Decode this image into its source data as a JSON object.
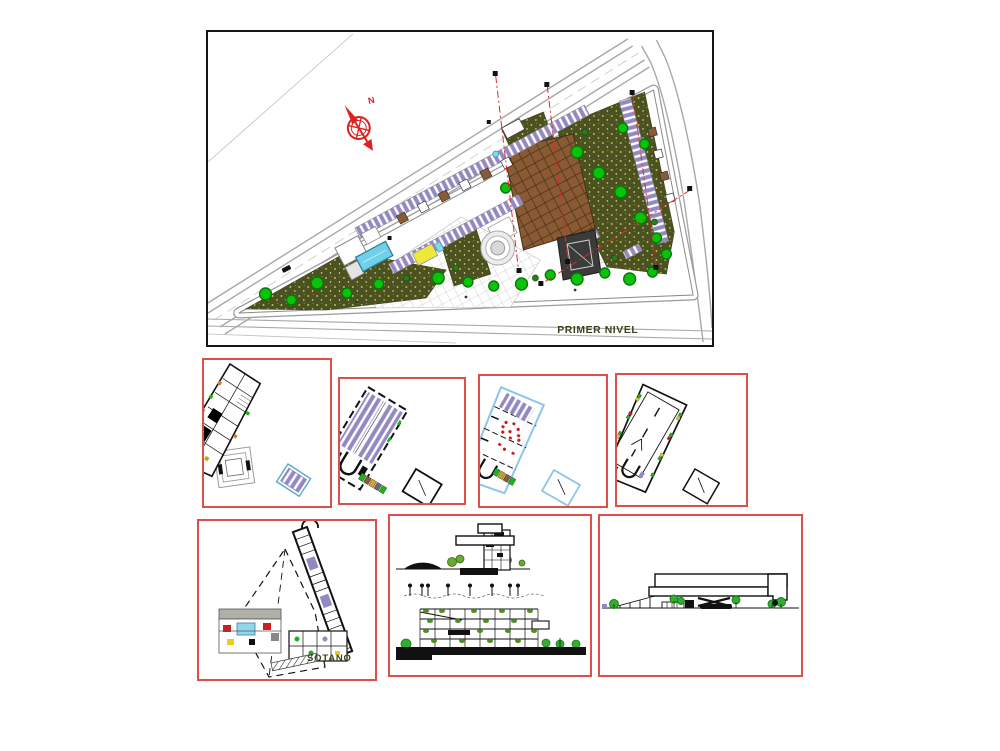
{
  "sheet": {
    "title": "architectural plan sheet",
    "background": "#ffffff"
  },
  "site_plan": {
    "label": "PRIMER NIVEL",
    "compass_label": "N"
  },
  "basement_plan": {
    "label": "SOTANO"
  },
  "colors": {
    "frame_red": "#dd4f48",
    "frame_black": "#151515",
    "label_olive": "#3c421a",
    "ground_olive": "#4b511f",
    "parking_purple": "#9488c2",
    "deck_brown": "#8a5a33",
    "tree_green": "#0ac20a",
    "pool_cyan": "#6fd0ea",
    "compass_red": "#e02020",
    "section_line_red": "#e02828",
    "plan3_outline_blue": "#8ec6e8",
    "road_gray": "#a8a8a8"
  }
}
